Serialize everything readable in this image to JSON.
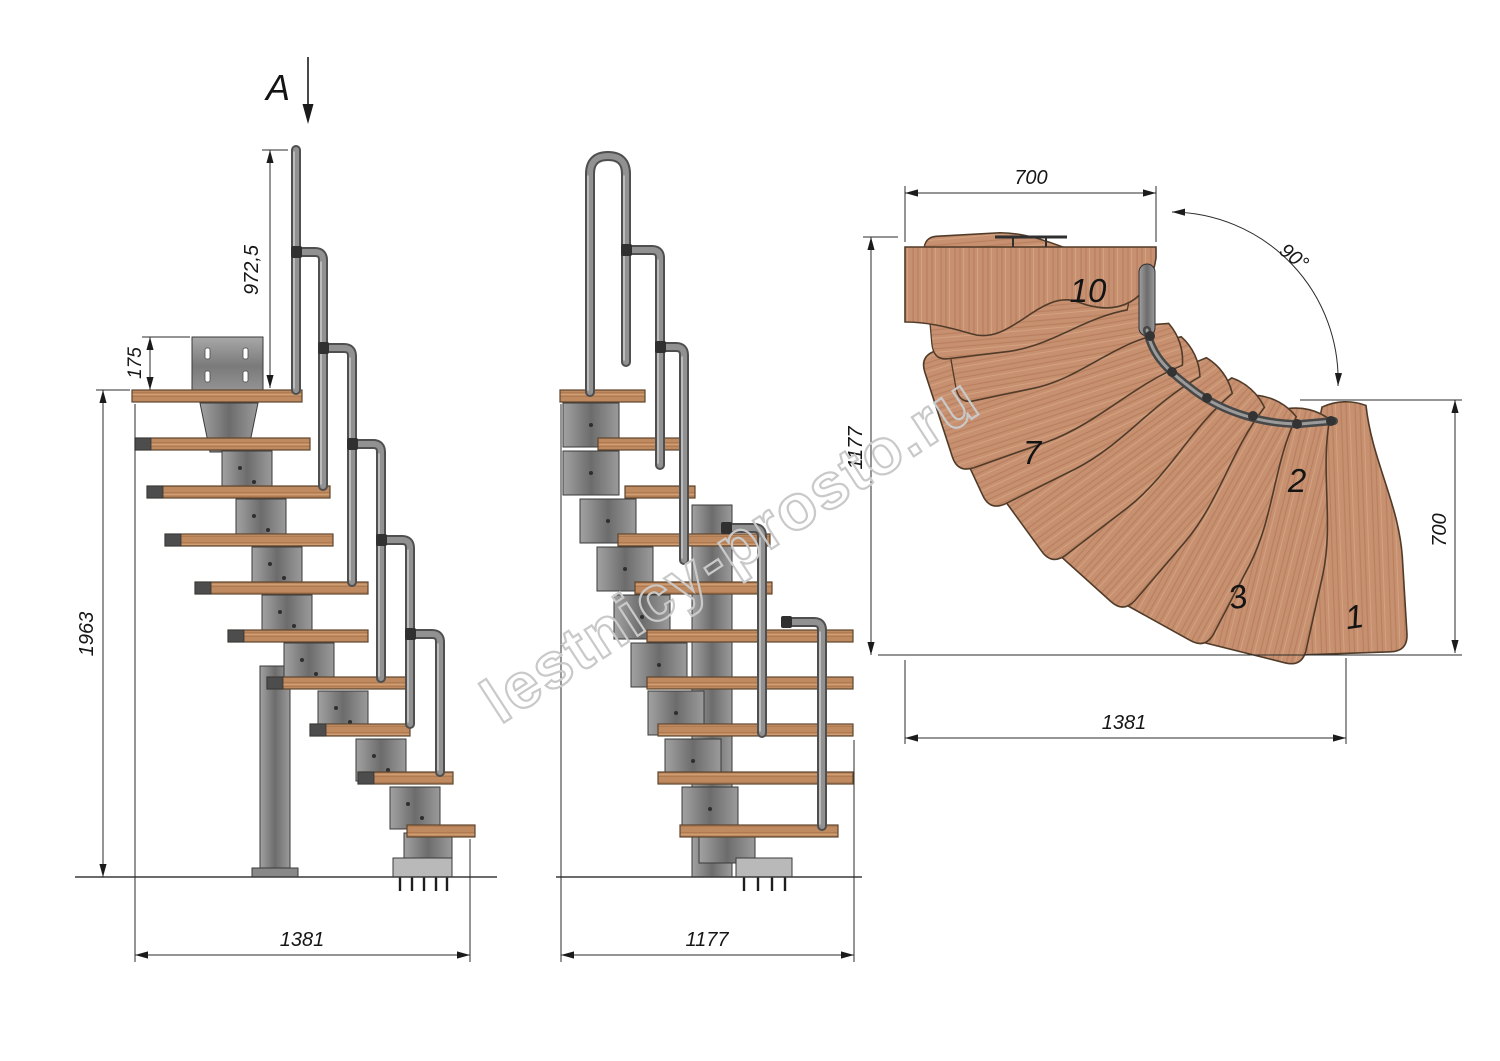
{
  "drawing": {
    "section_marker": {
      "label": "A"
    },
    "watermark": {
      "text": "lestnicy-prosto.ru",
      "color": "#c9c9c9"
    },
    "side_view": {
      "dims": {
        "handrail_height": "972,5",
        "bracket_offset": "175",
        "total_height": "1963",
        "base_length": "1381"
      }
    },
    "front_view": {
      "dims": {
        "base_width": "1177"
      }
    },
    "plan_view": {
      "dims": {
        "landing_width": "700",
        "left_depth": "1177",
        "right_depth": "700",
        "overall_length": "1381",
        "turn_angle": "90°"
      },
      "tread_labels": {
        "t10": "10",
        "t7": "7",
        "t2": "2",
        "t3": "3",
        "t1": "1"
      }
    },
    "colors": {
      "wood": "#c08a60",
      "wood_plan": "#c79071",
      "steel": "#8a8a8a",
      "line": "#222222"
    }
  }
}
